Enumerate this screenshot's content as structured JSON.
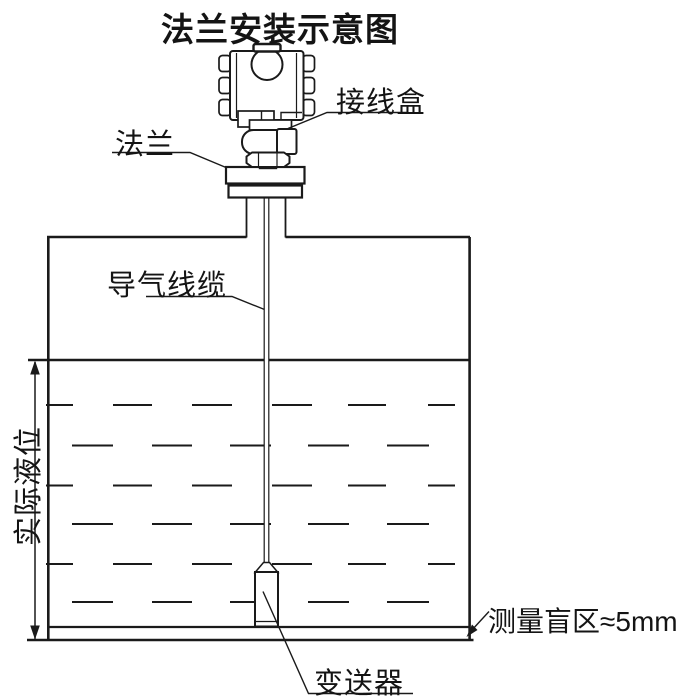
{
  "title": "法兰安装示意图",
  "labels": {
    "junction_box": "接线盒",
    "flange": "法兰",
    "air_cable": "导气线缆",
    "actual_level": "实际液位",
    "transmitter": "变送器",
    "blind_zone": "测量盲区≈5mm"
  },
  "colors": {
    "line": "#1a1a1a",
    "background": "#ffffff"
  }
}
